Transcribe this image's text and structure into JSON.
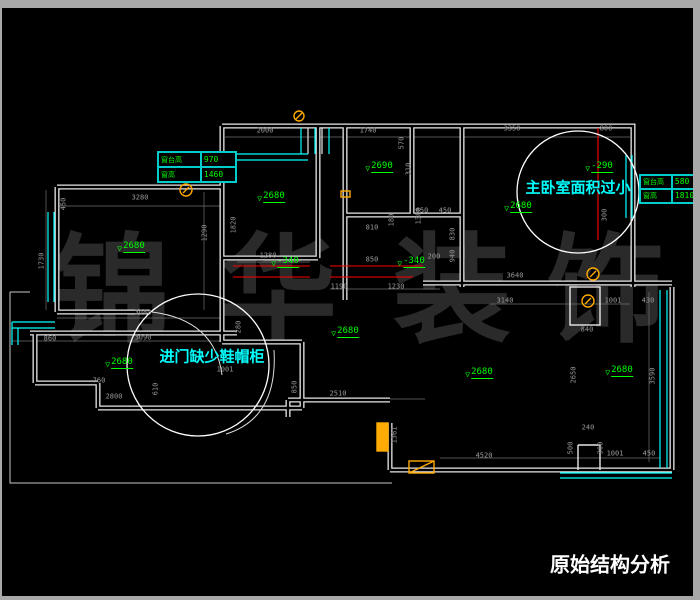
{
  "title": {
    "text": "原始结构分析",
    "x": 610,
    "y": 563,
    "size": 20
  },
  "watermark": {
    "chars": [
      "锦",
      "华",
      "装",
      "饰"
    ],
    "xs": [
      112,
      278,
      452,
      606
    ],
    "y": 287,
    "size": 118,
    "color": "#2a2a2a"
  },
  "annotations": [
    {
      "text": "主卧室面积过小",
      "x": 578,
      "y": 187,
      "size": 15
    },
    {
      "text": "进门缺少鞋帽柜",
      "x": 212,
      "y": 356,
      "size": 15
    }
  ],
  "info_tables": [
    {
      "x": 157,
      "y": 151,
      "w": 78,
      "h": 30,
      "rows": [
        [
          "窗台高",
          "970"
        ],
        [
          "窗高",
          "1460"
        ]
      ]
    },
    {
      "x": 639,
      "y": 174,
      "w": 58,
      "h": 28,
      "rows": [
        [
          "窗台高",
          "580"
        ],
        [
          "窗高",
          "1810"
        ]
      ]
    }
  ],
  "level_markers": [
    {
      "t": "2680",
      "x": 131,
      "y": 246
    },
    {
      "t": "2680",
      "x": 271,
      "y": 196
    },
    {
      "t": "2690",
      "x": 379,
      "y": 166
    },
    {
      "t": "2680",
      "x": 518,
      "y": 206
    },
    {
      "t": "-290",
      "x": 599,
      "y": 166
    },
    {
      "t": "-340",
      "x": 285,
      "y": 261
    },
    {
      "t": "-340",
      "x": 411,
      "y": 261
    },
    {
      "t": "2680",
      "x": 345,
      "y": 331
    },
    {
      "t": "2680",
      "x": 119,
      "y": 362
    },
    {
      "t": "2680",
      "x": 479,
      "y": 372
    },
    {
      "t": "2680",
      "x": 619,
      "y": 370
    }
  ],
  "dim_labels": [
    {
      "t": "2000",
      "x": 265,
      "y": 131,
      "r": 0
    },
    {
      "t": "1740",
      "x": 368,
      "y": 131,
      "r": 0
    },
    {
      "t": "3350",
      "x": 512,
      "y": 129,
      "r": 0
    },
    {
      "t": "800",
      "x": 606,
      "y": 129,
      "r": 0
    },
    {
      "t": "3280",
      "x": 140,
      "y": 198,
      "r": 0
    },
    {
      "t": "450",
      "x": 64,
      "y": 204,
      "r": 90
    },
    {
      "t": "1730",
      "x": 42,
      "y": 261,
      "r": 90
    },
    {
      "t": "1290",
      "x": 205,
      "y": 233,
      "r": 90
    },
    {
      "t": "1820",
      "x": 234,
      "y": 225,
      "r": 90
    },
    {
      "t": "3080",
      "x": 143,
      "y": 313,
      "r": 0
    },
    {
      "t": "3090",
      "x": 143,
      "y": 338,
      "r": 0
    },
    {
      "t": "570",
      "x": 402,
      "y": 143,
      "r": 90
    },
    {
      "t": "310",
      "x": 409,
      "y": 169,
      "r": 90
    },
    {
      "t": "1380",
      "x": 419,
      "y": 216,
      "r": 90
    },
    {
      "t": "650",
      "x": 422,
      "y": 211,
      "r": 0
    },
    {
      "t": "450",
      "x": 445,
      "y": 211,
      "r": 0
    },
    {
      "t": "180",
      "x": 392,
      "y": 220,
      "r": 90
    },
    {
      "t": "810",
      "x": 372,
      "y": 228,
      "r": 0
    },
    {
      "t": "300",
      "x": 605,
      "y": 215,
      "r": 90
    },
    {
      "t": "830",
      "x": 453,
      "y": 234,
      "r": 90
    },
    {
      "t": "940",
      "x": 453,
      "y": 256,
      "r": 90
    },
    {
      "t": "1280",
      "x": 268,
      "y": 256,
      "r": 0
    },
    {
      "t": "850",
      "x": 372,
      "y": 260,
      "r": 0
    },
    {
      "t": "200",
      "x": 434,
      "y": 257,
      "r": 0
    },
    {
      "t": "1190",
      "x": 339,
      "y": 287,
      "r": 0
    },
    {
      "t": "1230",
      "x": 396,
      "y": 287,
      "r": 0
    },
    {
      "t": "3640",
      "x": 515,
      "y": 276,
      "r": 0
    },
    {
      "t": "3140",
      "x": 505,
      "y": 301,
      "r": 0
    },
    {
      "t": "840",
      "x": 587,
      "y": 330,
      "r": 0
    },
    {
      "t": "1001",
      "x": 613,
      "y": 301,
      "r": 0
    },
    {
      "t": "430",
      "x": 648,
      "y": 301,
      "r": 0
    },
    {
      "t": "2510",
      "x": 338,
      "y": 394,
      "r": 0
    },
    {
      "t": "850",
      "x": 295,
      "y": 387,
      "r": 90
    },
    {
      "t": "1361",
      "x": 395,
      "y": 435,
      "r": 90
    },
    {
      "t": "4520",
      "x": 484,
      "y": 456,
      "r": 0
    },
    {
      "t": "2650",
      "x": 574,
      "y": 375,
      "r": 90
    },
    {
      "t": "3590",
      "x": 653,
      "y": 376,
      "r": 90
    },
    {
      "t": "240",
      "x": 588,
      "y": 428,
      "r": 0
    },
    {
      "t": "500",
      "x": 571,
      "y": 448,
      "r": 90
    },
    {
      "t": "300",
      "x": 601,
      "y": 448,
      "r": 90
    },
    {
      "t": "1001",
      "x": 615,
      "y": 454,
      "r": 0
    },
    {
      "t": "450",
      "x": 649,
      "y": 454,
      "r": 0
    },
    {
      "t": "760",
      "x": 99,
      "y": 381,
      "r": 0
    },
    {
      "t": "610",
      "x": 156,
      "y": 389,
      "r": 90
    },
    {
      "t": "2800",
      "x": 114,
      "y": 397,
      "r": 0
    },
    {
      "t": "860",
      "x": 50,
      "y": 339,
      "r": 0
    },
    {
      "t": "1001",
      "x": 225,
      "y": 370,
      "r": 0
    },
    {
      "t": "280",
      "x": 239,
      "y": 327,
      "r": 90
    }
  ],
  "colors": {
    "background": "#000000",
    "chrome": "#a8a8a8",
    "wall": "#e8e8e8",
    "window_line": "#00ffff",
    "level_marker": "#00ff00",
    "demolition_line": "#ff0000",
    "fixture": "#ffaa00",
    "dimension_text": "#9a9a9a",
    "callout_text": "#00ffff",
    "watermark": "#2a2a2a",
    "title_text": "#ffffff"
  }
}
